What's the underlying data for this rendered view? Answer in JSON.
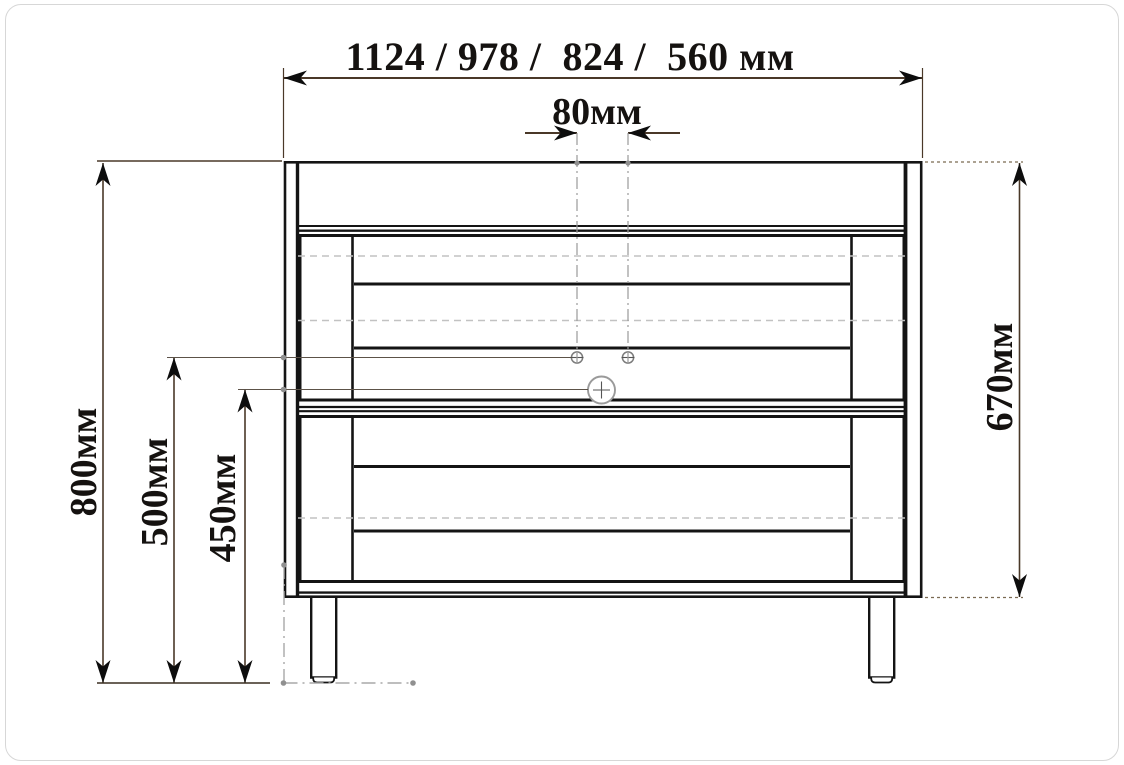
{
  "drawing": {
    "type": "furniture front-view dimension drawing",
    "units": "мм",
    "dims": {
      "width_options": "1124 / 978 /  824 /  560 мм",
      "hole_spacing": "80мм",
      "overall_height": "800мм",
      "holes_height": "500мм",
      "center_hole_height": "450мм",
      "body_height": "670мм"
    },
    "colors": {
      "cabinet_line": "#141414",
      "dimension_line": "#4a3828",
      "arrow": "#0d0d0d",
      "centerline_gray": "#9a9a9a",
      "slat_dash_gray": "#c2c2c2",
      "marker_dot_gray": "#909090",
      "page_border": "#d7d7d7"
    }
  }
}
